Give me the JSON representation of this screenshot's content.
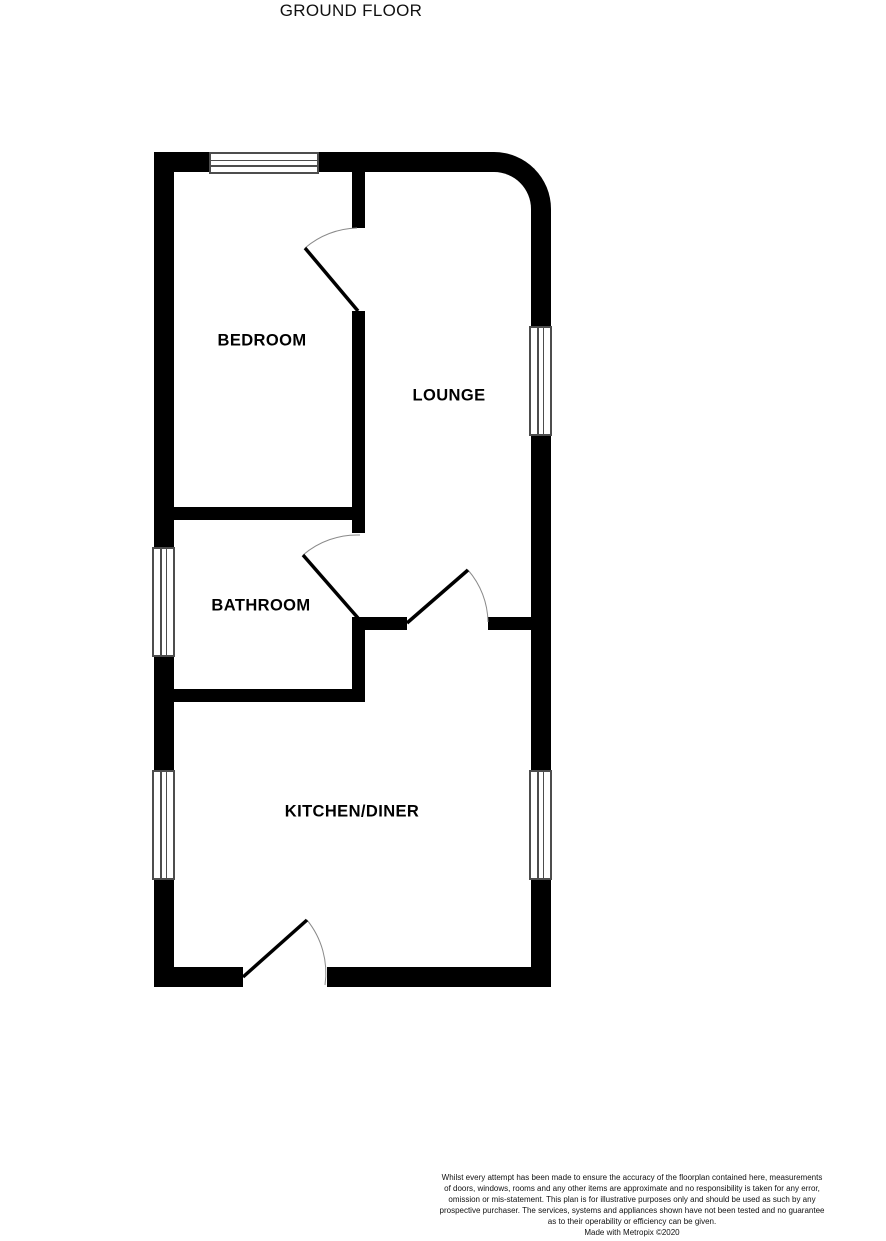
{
  "title": "GROUND FLOOR",
  "rooms": [
    {
      "name": "BEDROOM"
    },
    {
      "name": "LOUNGE"
    },
    {
      "name": "BATHROOM"
    },
    {
      "name": "KITCHEN/DINER"
    }
  ],
  "elements": {
    "doors": [
      "bedroom-door",
      "bathroom-door",
      "hall-door",
      "entrance-door"
    ],
    "windows": [
      "bedroom-window",
      "lounge-window",
      "bathroom-window",
      "kitchen-window-left",
      "kitchen-window-right"
    ]
  },
  "colors": {
    "wall": "#000000",
    "background": "#ffffff",
    "window_frame": "#4d4d4d",
    "door_arc": "#8a8a8a"
  },
  "footer": {
    "disclaimer_lines": [
      "Whilst every attempt has been made to ensure the accuracy of the floorplan contained here, measurements",
      "of doors, windows, rooms and any other items are approximate and no responsibility is taken for any error,",
      "omission or mis-statement. This plan is for illustrative purposes only and should be used as such by any",
      "prospective purchaser. The services, systems and appliances shown have not been tested and no guarantee",
      "as to their operability or efficiency can be given."
    ],
    "credit": "Made with Metropix ©2020"
  }
}
